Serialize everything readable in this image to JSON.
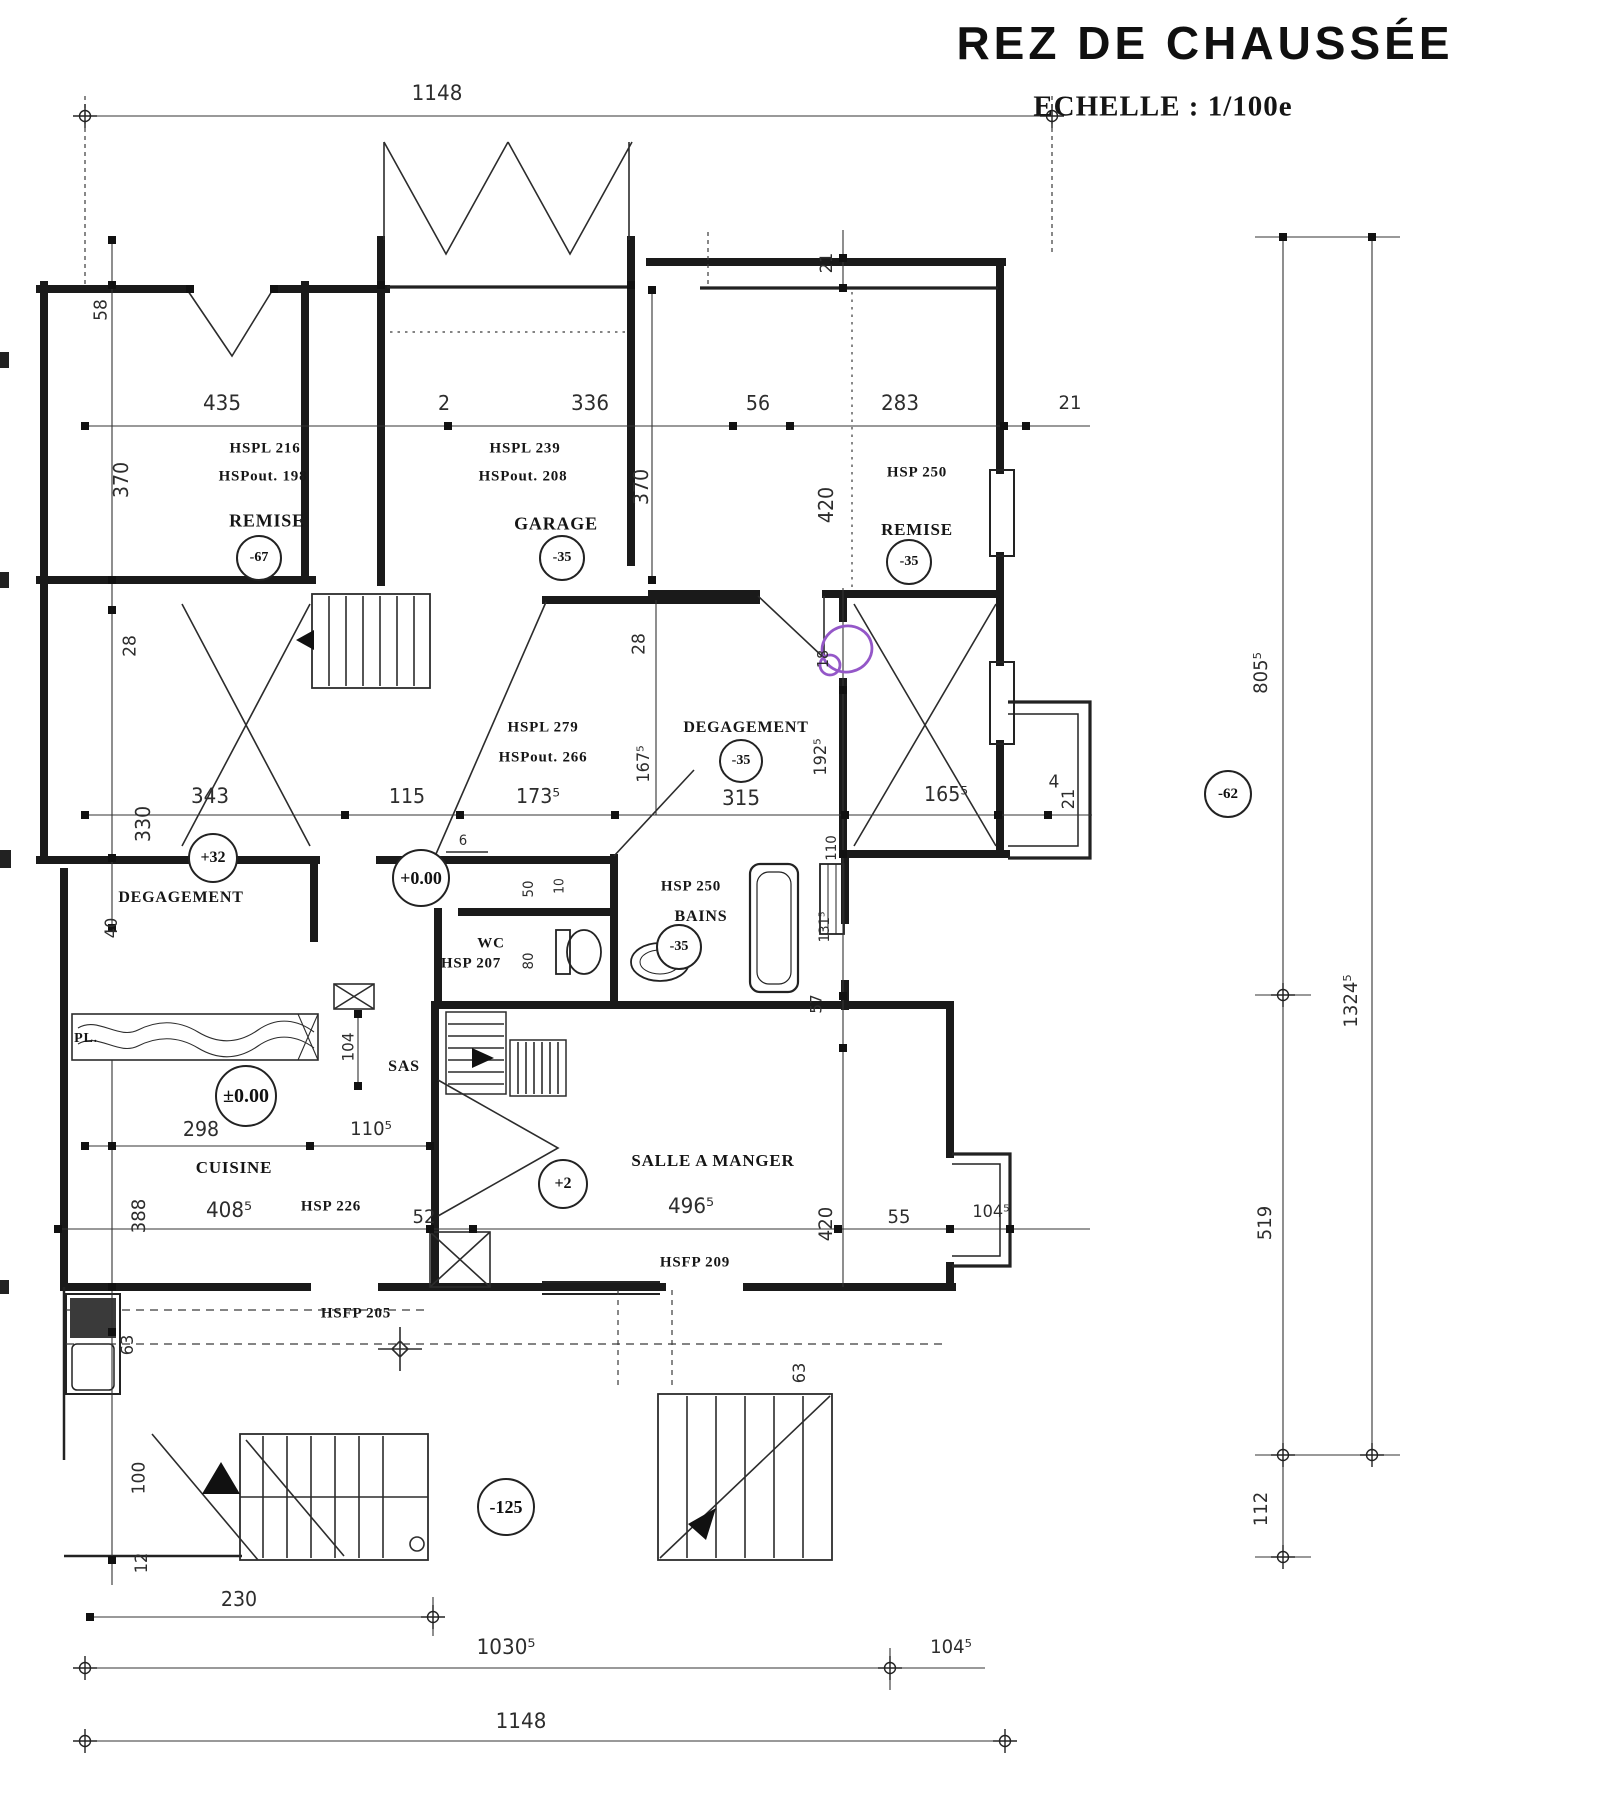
{
  "page": {
    "title": "REZ DE CHAUSSÉE",
    "scale_label": "ECHELLE : 1/100e"
  },
  "colors": {
    "ink": "#1a1a1a",
    "dim_text": "#2d2d2d",
    "annotation_purple": "#9457c8",
    "paper": "#ffffff"
  },
  "plan": {
    "dimension_labels": [
      {
        "name": "dim-1148-top",
        "text": "1148",
        "x": 437,
        "y": 93,
        "rot": 0,
        "size": 21
      },
      {
        "name": "dim-435",
        "text": "435",
        "x": 222,
        "y": 403,
        "rot": 0,
        "size": 21
      },
      {
        "name": "dim-2",
        "text": "2",
        "x": 444,
        "y": 403,
        "rot": 0,
        "size": 20
      },
      {
        "name": "dim-336",
        "text": "336",
        "x": 590,
        "y": 403,
        "rot": 0,
        "size": 21
      },
      {
        "name": "dim-56",
        "text": "56",
        "x": 758,
        "y": 403,
        "rot": 0,
        "size": 20
      },
      {
        "name": "dim-283",
        "text": "283",
        "x": 900,
        "y": 403,
        "rot": 0,
        "size": 21
      },
      {
        "name": "dim-21-top",
        "text": "21",
        "x": 1070,
        "y": 403,
        "rot": 0,
        "size": 19
      },
      {
        "name": "dim-58",
        "text": "58",
        "x": 101,
        "y": 310,
        "rot": 1,
        "size": 18
      },
      {
        "name": "dim-370-left",
        "text": "370",
        "x": 121,
        "y": 480,
        "rot": 1,
        "size": 20
      },
      {
        "name": "dim-28-left",
        "text": "28",
        "x": 130,
        "y": 646,
        "rot": 1,
        "size": 18
      },
      {
        "name": "dim-330",
        "text": "330",
        "x": 143,
        "y": 824,
        "rot": 1,
        "size": 20
      },
      {
        "name": "dim-40",
        "text": "40",
        "x": 112,
        "y": 928,
        "rot": 1,
        "size": 17
      },
      {
        "name": "dim-388",
        "text": "388",
        "x": 139,
        "y": 1216,
        "rot": 1,
        "size": 19
      },
      {
        "name": "dim-63-left",
        "text": "63",
        "x": 128,
        "y": 1345,
        "rot": 1,
        "size": 17
      },
      {
        "name": "dim-100",
        "text": "100",
        "x": 139,
        "y": 1478,
        "rot": 1,
        "size": 18
      },
      {
        "name": "dim-12",
        "text": "12",
        "x": 142,
        "y": 1563,
        "rot": 1,
        "size": 17
      },
      {
        "name": "dim-370-garage",
        "text": "370",
        "x": 641,
        "y": 487,
        "rot": 1,
        "size": 20
      },
      {
        "name": "dim-21-wall",
        "text": "21",
        "x": 827,
        "y": 263,
        "rot": 1,
        "size": 17
      },
      {
        "name": "dim-420-remise",
        "text": "420",
        "x": 826,
        "y": 505,
        "rot": 1,
        "size": 20
      },
      {
        "name": "dim-18-circled",
        "text": "18",
        "x": 823,
        "y": 659,
        "rot": 1,
        "size": 15
      },
      {
        "name": "dim-192half",
        "text": "192⁵",
        "x": 821,
        "y": 757,
        "rot": 1,
        "size": 17
      },
      {
        "name": "dim-110-bains",
        "text": "110",
        "x": 832,
        "y": 848,
        "rot": 1,
        "size": 14
      },
      {
        "name": "dim-131half",
        "text": "131⁵",
        "x": 825,
        "y": 927,
        "rot": 1,
        "size": 14
      },
      {
        "name": "dim-57-salle",
        "text": "57",
        "x": 816,
        "y": 1004,
        "rot": 1,
        "size": 16
      },
      {
        "name": "dim-420-salle",
        "text": "420",
        "x": 826,
        "y": 1224,
        "rot": 1,
        "size": 19
      },
      {
        "name": "dim-63-salle",
        "text": "63",
        "x": 800,
        "y": 1373,
        "rot": 1,
        "size": 17
      },
      {
        "name": "dim-28-mid",
        "text": "28",
        "x": 639,
        "y": 644,
        "rot": 1,
        "size": 18
      },
      {
        "name": "dim-167half",
        "text": "167⁵",
        "x": 644,
        "y": 764,
        "rot": 1,
        "size": 17
      },
      {
        "name": "dim-343",
        "text": "343",
        "x": 210,
        "y": 796,
        "rot": 0,
        "size": 21
      },
      {
        "name": "dim-115",
        "text": "115",
        "x": 407,
        "y": 796,
        "rot": 0,
        "size": 20
      },
      {
        "name": "dim-173half",
        "text": "173⁵",
        "x": 538,
        "y": 796,
        "rot": 0,
        "size": 20
      },
      {
        "name": "dim-315",
        "text": "315",
        "x": 741,
        "y": 798,
        "rot": 0,
        "size": 21
      },
      {
        "name": "dim-165half",
        "text": "165⁵",
        "x": 946,
        "y": 794,
        "rot": 0,
        "size": 20
      },
      {
        "name": "dim-4",
        "text": "4",
        "x": 1054,
        "y": 782,
        "rot": 0,
        "size": 18
      },
      {
        "name": "dim-21-bay",
        "text": "21",
        "x": 1069,
        "y": 799,
        "rot": 1,
        "size": 17
      },
      {
        "name": "dim-6",
        "text": "6",
        "x": 463,
        "y": 841,
        "rot": 0,
        "size": 14
      },
      {
        "name": "dim-50",
        "text": "50",
        "x": 529,
        "y": 889,
        "rot": 1,
        "size": 14
      },
      {
        "name": "dim-10",
        "text": "10",
        "x": 560,
        "y": 886,
        "rot": 1,
        "size": 13
      },
      {
        "name": "dim-80",
        "text": "80",
        "x": 529,
        "y": 961,
        "rot": 1,
        "size": 14
      },
      {
        "name": "dim-104-sas",
        "text": "104",
        "x": 348,
        "y": 1047,
        "rot": 1,
        "size": 16
      },
      {
        "name": "dim-298",
        "text": "298",
        "x": 201,
        "y": 1129,
        "rot": 0,
        "size": 20
      },
      {
        "name": "dim-110half",
        "text": "110⁵",
        "x": 371,
        "y": 1129,
        "rot": 0,
        "size": 19
      },
      {
        "name": "dim-408half",
        "text": "408⁵",
        "x": 229,
        "y": 1210,
        "rot": 0,
        "size": 21
      },
      {
        "name": "dim-52",
        "text": "52",
        "x": 424,
        "y": 1217,
        "rot": 0,
        "size": 19
      },
      {
        "name": "dim-496half",
        "text": "496⁵",
        "x": 691,
        "y": 1206,
        "rot": 0,
        "size": 21
      },
      {
        "name": "dim-55",
        "text": "55",
        "x": 899,
        "y": 1217,
        "rot": 0,
        "size": 19
      },
      {
        "name": "dim-104half-mid",
        "text": "104⁵",
        "x": 991,
        "y": 1212,
        "rot": 0,
        "size": 17
      },
      {
        "name": "dim-230",
        "text": "230",
        "x": 239,
        "y": 1599,
        "rot": 0,
        "size": 20
      },
      {
        "name": "dim-1030half",
        "text": "1030⁵",
        "x": 506,
        "y": 1647,
        "rot": 0,
        "size": 21
      },
      {
        "name": "dim-104half-bottom",
        "text": "104⁵",
        "x": 951,
        "y": 1647,
        "rot": 0,
        "size": 19
      },
      {
        "name": "dim-1148-bottom",
        "text": "1148",
        "x": 521,
        "y": 1721,
        "rot": 0,
        "size": 21
      },
      {
        "name": "dim-805half",
        "text": "805⁵",
        "x": 1261,
        "y": 673,
        "rot": 1,
        "size": 19
      },
      {
        "name": "dim-1324half",
        "text": "1324⁵",
        "x": 1351,
        "y": 1001,
        "rot": 1,
        "size": 19
      },
      {
        "name": "dim-519",
        "text": "519",
        "x": 1265,
        "y": 1223,
        "rot": 1,
        "size": 19
      },
      {
        "name": "dim-112",
        "text": "112",
        "x": 1261,
        "y": 1509,
        "rot": 1,
        "size": 19
      }
    ],
    "room_labels": [
      {
        "name": "room-remise-left-hspl",
        "text": "HSPL   216",
        "x": 265,
        "y": 449,
        "size": 15
      },
      {
        "name": "room-remise-left-hspout",
        "text": "HSPout. 198",
        "x": 263,
        "y": 477,
        "size": 15
      },
      {
        "name": "room-remise-left",
        "text": "REMISE",
        "x": 267,
        "y": 521,
        "size": 18
      },
      {
        "name": "room-garage-hspl",
        "text": "HSPL   239",
        "x": 525,
        "y": 449,
        "size": 15
      },
      {
        "name": "room-garage-hspout",
        "text": "HSPout. 208",
        "x": 523,
        "y": 477,
        "size": 15
      },
      {
        "name": "room-garage",
        "text": "GARAGE",
        "x": 556,
        "y": 524,
        "size": 18
      },
      {
        "name": "room-remise-right-hsp",
        "text": "HSP 250",
        "x": 917,
        "y": 473,
        "size": 15
      },
      {
        "name": "room-remise-right",
        "text": "REMISE",
        "x": 917,
        "y": 530,
        "size": 17
      },
      {
        "name": "room-stairs-hspl",
        "text": "HSPL   279",
        "x": 543,
        "y": 728,
        "size": 15
      },
      {
        "name": "room-stairs-hspout",
        "text": "HSPout. 266",
        "x": 543,
        "y": 758,
        "size": 15
      },
      {
        "name": "room-degagement-center",
        "text": "DEGAGEMENT",
        "x": 746,
        "y": 728,
        "size": 16
      },
      {
        "name": "room-degagement-left",
        "text": "DEGAGEMENT",
        "x": 181,
        "y": 898,
        "size": 16
      },
      {
        "name": "room-bains-hsp",
        "text": "HSP 250",
        "x": 691,
        "y": 887,
        "size": 15
      },
      {
        "name": "room-bains",
        "text": "BAINS",
        "x": 701,
        "y": 917,
        "size": 16
      },
      {
        "name": "room-wc",
        "text": "WC",
        "x": 491,
        "y": 944,
        "size": 15
      },
      {
        "name": "room-wc-hsp",
        "text": "HSP 207",
        "x": 471,
        "y": 964,
        "size": 15
      },
      {
        "name": "room-sas",
        "text": "SAS",
        "x": 404,
        "y": 1067,
        "size": 16
      },
      {
        "name": "room-pl",
        "text": "PL.",
        "x": 86,
        "y": 1039,
        "size": 14
      },
      {
        "name": "room-cuisine",
        "text": "CUISINE",
        "x": 234,
        "y": 1168,
        "size": 17
      },
      {
        "name": "room-cuisine-hsp",
        "text": "HSP 226",
        "x": 331,
        "y": 1207,
        "size": 15
      },
      {
        "name": "room-salle-a-manger",
        "text": "SALLE A MANGER",
        "x": 713,
        "y": 1161,
        "size": 17
      },
      {
        "name": "room-salle-hsfp",
        "text": "HSFP 209",
        "x": 695,
        "y": 1263,
        "size": 15
      },
      {
        "name": "room-hsfp-205",
        "text": "HSFP 205",
        "x": 356,
        "y": 1314,
        "size": 15
      }
    ],
    "level_markers": [
      {
        "name": "level-remise-left",
        "text": "-67",
        "x": 259,
        "y": 558,
        "dia": 42
      },
      {
        "name": "level-garage",
        "text": "-35",
        "x": 562,
        "y": 558,
        "dia": 42
      },
      {
        "name": "level-remise-right",
        "text": "-35",
        "x": 909,
        "y": 562,
        "dia": 42
      },
      {
        "name": "level-degagement-center",
        "text": "-35",
        "x": 741,
        "y": 761,
        "dia": 40
      },
      {
        "name": "level-degagement-left",
        "text": "+32",
        "x": 213,
        "y": 858,
        "dia": 46
      },
      {
        "name": "level-hall",
        "text": "+0.00",
        "x": 421,
        "y": 878,
        "dia": 54
      },
      {
        "name": "level-bains",
        "text": "-35",
        "x": 679,
        "y": 947,
        "dia": 42
      },
      {
        "name": "level-cuisine",
        "text": "±0.00",
        "x": 246,
        "y": 1096,
        "dia": 58
      },
      {
        "name": "level-salle",
        "text": "+2",
        "x": 563,
        "y": 1184,
        "dia": 46
      },
      {
        "name": "level-porch",
        "text": "-125",
        "x": 506,
        "y": 1507,
        "dia": 54
      },
      {
        "name": "level-terrain",
        "text": "-62",
        "x": 1228,
        "y": 794,
        "dia": 44
      }
    ]
  }
}
